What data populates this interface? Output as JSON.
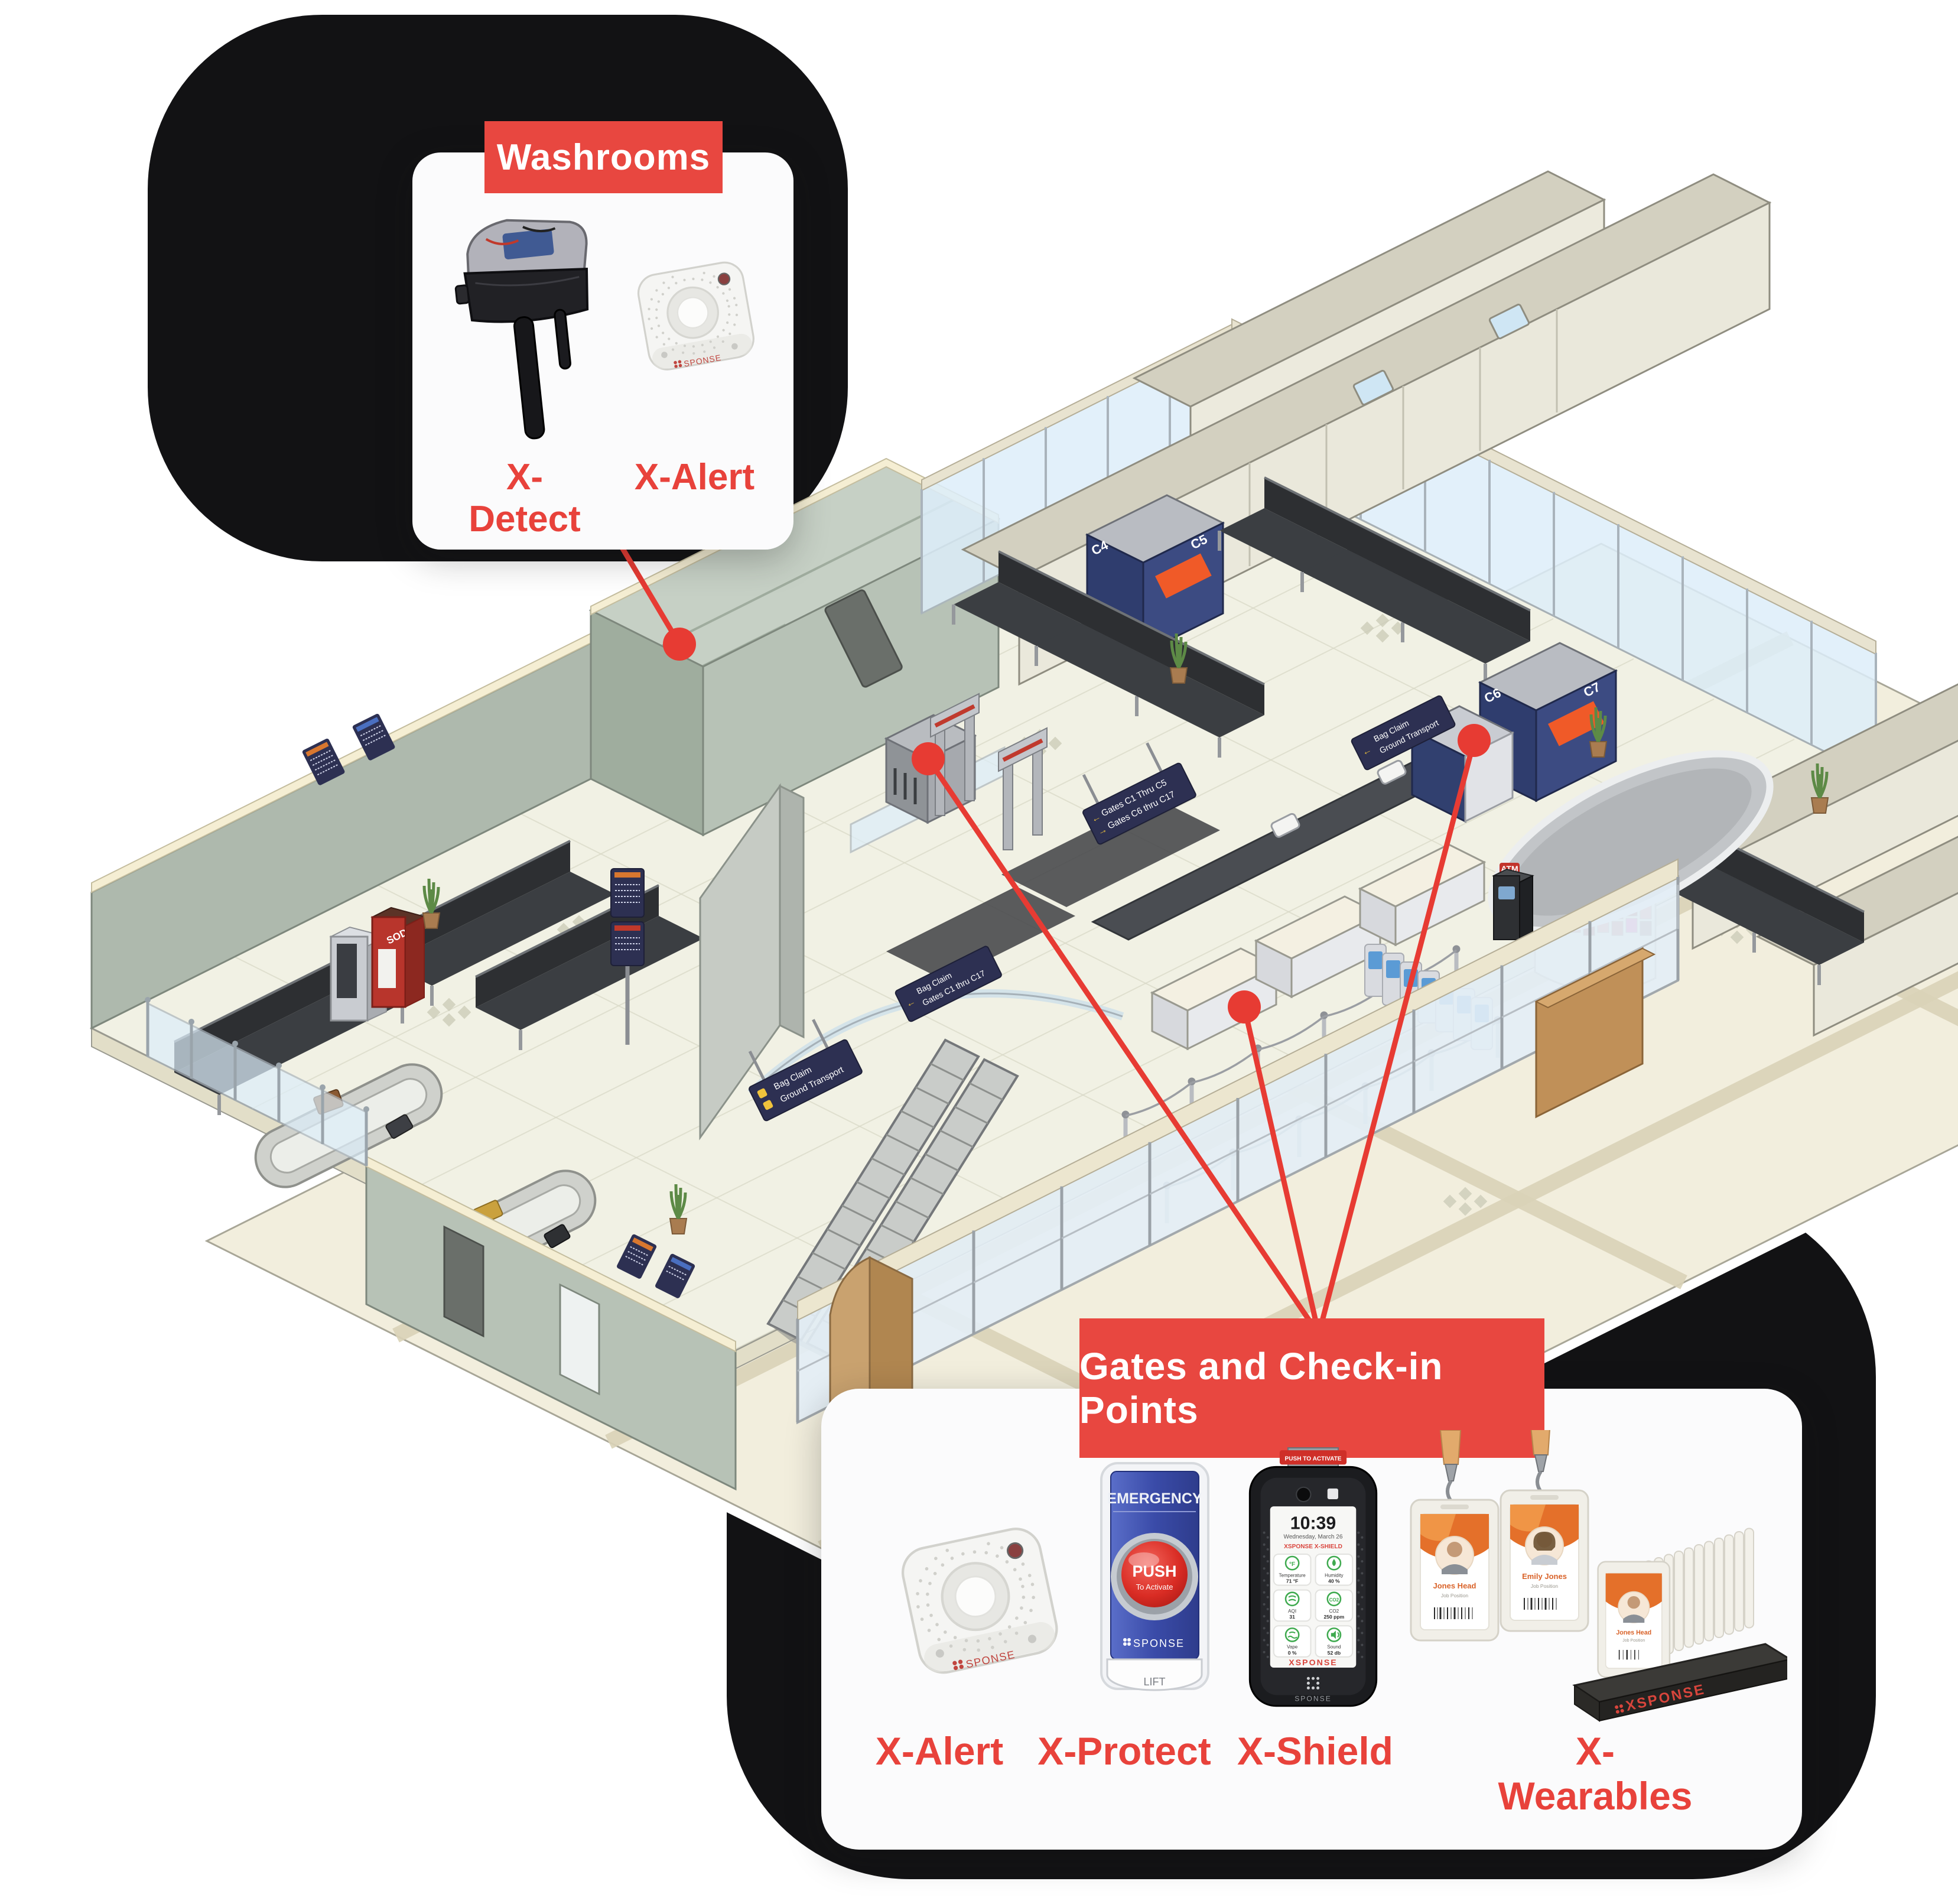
{
  "brand": {
    "wordmark": "XSPONSE",
    "short": "SPONSE",
    "accent_red": "#E84740",
    "line_red": "#E73B33",
    "blob_black": "#121214"
  },
  "callouts": {
    "washrooms": {
      "title": "Washrooms",
      "products": [
        {
          "name": "X-Detect"
        },
        {
          "name": "X-Alert",
          "device_brand": "SPONSE"
        }
      ]
    },
    "gates": {
      "title": "Gates and Check-in Points",
      "products": [
        {
          "name": "X-Alert",
          "device_brand": "SPONSE"
        },
        {
          "name": "X-Protect",
          "device": {
            "header": "EMERGENCY",
            "button": "PUSH",
            "button_sub": "To Activate",
            "brand": "SPONSE",
            "base_label": "LIFT"
          }
        },
        {
          "name": "X-Shield",
          "device": {
            "top_banner": "PUSH TO ACTIVATE",
            "time": "10:39",
            "date": "Wednesday, March 26",
            "app_title": "XSPONSE X-SHIELD",
            "tiles": [
              {
                "label": "Temperature",
                "value": "71 °F"
              },
              {
                "label": "Humidity",
                "value": "40 %"
              },
              {
                "label": "AQI",
                "value": "31"
              },
              {
                "label": "CO2",
                "value": "250 ppm"
              },
              {
                "label": "Vape",
                "value": "0 %"
              },
              {
                "label": "Sound",
                "value": "52 db"
              }
            ],
            "screen_brand": "XSPONSE",
            "bezel_brand": "SPONSE"
          }
        },
        {
          "name": "X-Wearables",
          "badges": [
            {
              "name": "Jones Head",
              "title": "Job Position"
            },
            {
              "name": "Emily Jones",
              "title": "Job Position"
            }
          ],
          "dock_brand": "XSPONSE"
        }
      ]
    }
  },
  "map": {
    "gate_counters": [
      {
        "a": "C4",
        "b": "C5"
      },
      {
        "a": "C6",
        "b": "C7"
      }
    ],
    "signs": {
      "gates_split_1": "Gates C1 Thru C5",
      "gates_split_2": "Gates C6 thru C17",
      "bag_ground_1": "Bag Claim",
      "bag_ground_2": "Ground Transport",
      "bag_gates_1": "Bag Claim",
      "bag_gates_2": "Gates C1 thru C17"
    },
    "vending_label": "SODA",
    "atm_label": "ATM"
  }
}
